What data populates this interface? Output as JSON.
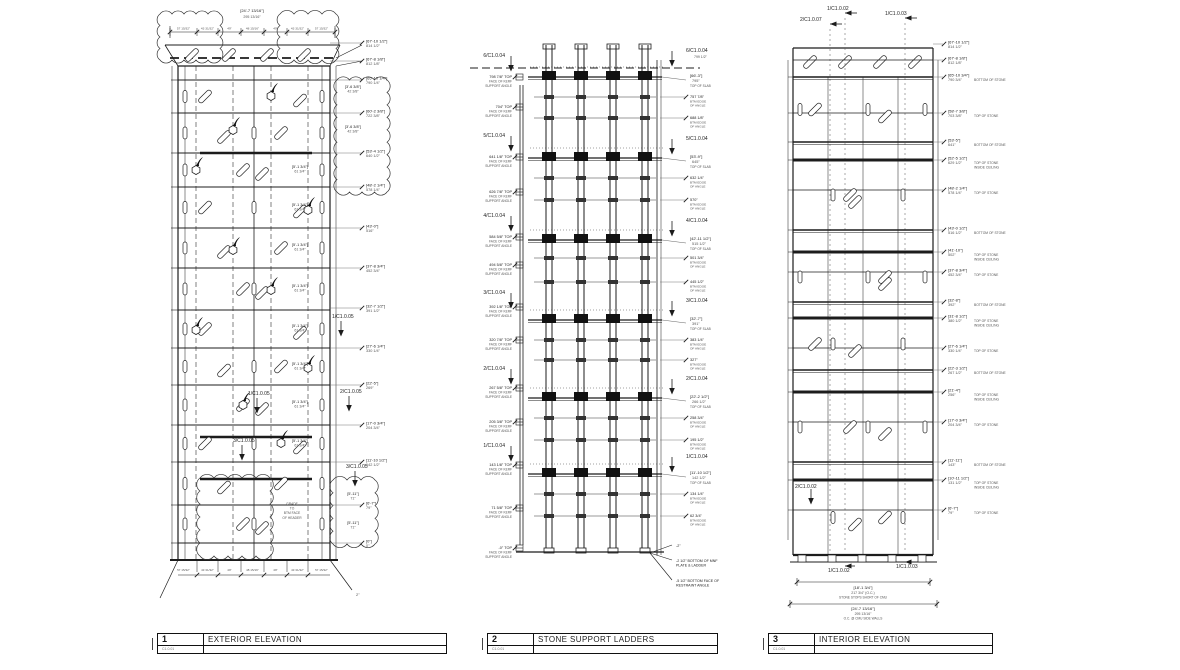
{
  "colors": {
    "ink": "#1c1c1c",
    "dim": "#555555",
    "bg": "#ffffff"
  },
  "title_blocks": [
    {
      "number": "1",
      "title": "EXTERIOR ELEVATION",
      "scale": "C1.0.01"
    },
    {
      "number": "2",
      "title": "STONE SUPPORT LADDERS",
      "scale": "C1.0.01"
    },
    {
      "number": "3",
      "title": "INTERIOR ELEVATION",
      "scale": "C1.0.01"
    }
  ],
  "exterior": {
    "top_dim": {
      "bracket": "[24'-7 13/16\"]",
      "value": "295 13/16\""
    },
    "subdims": [
      "57 15/32\"",
      "43 31/32\"",
      "49\"",
      "48 15/16\"",
      "49\"",
      "43 31/32\"",
      "57 15/32\""
    ],
    "right_labels": [
      {
        "y": 43,
        "b": "[67'-10 1/2\"]",
        "v": "814 1/2\""
      },
      {
        "y": 61,
        "b": "[67'-8 1/8\"]",
        "v": "812 1/8\""
      },
      {
        "y": 80,
        "b": "[65'-10 1/4\"]",
        "v": "790 1/4\""
      },
      {
        "y": 113,
        "b": "[60'-2 3/8\"]",
        "v": "722 3/8\""
      },
      {
        "y": 153,
        "b": "[53'-4 1/2\"]",
        "v": "640 1/2\""
      },
      {
        "y": 187,
        "b": "[48'-2 1/4\"]",
        "v": "578 1/4\""
      },
      {
        "y": 228,
        "b": "[43'-0\"]",
        "v": "516\""
      },
      {
        "y": 268,
        "b": "[37'-8 3/4\"]",
        "v": "452 3/4\""
      },
      {
        "y": 308,
        "b": "[32'-7 1/2\"]",
        "v": "391 1/2\""
      },
      {
        "y": 348,
        "b": "[27'-6 1/4\"]",
        "v": "330 1/4\""
      },
      {
        "y": 385,
        "b": "[22'-5\"]",
        "v": "269\""
      },
      {
        "y": 425,
        "b": "[17'-0 3/4\"]",
        "v": "204 3/4\""
      },
      {
        "y": 462,
        "b": "[11'-10 1/2\"]",
        "v": "142 1/2\""
      },
      {
        "y": 505,
        "b": "[6'-7\"]",
        "v": "79\""
      },
      {
        "y": 543,
        "b": "[0\"]",
        "v": "0\""
      }
    ],
    "cell_labels": [
      {
        "x": 353,
        "y": 88,
        "b": "[3'-6 3/8\"]",
        "v": "42 3/8\""
      },
      {
        "x": 353,
        "y": 128,
        "b": "[3'-6 3/8\"]",
        "v": "42 3/8\""
      },
      {
        "x": 300,
        "y": 168,
        "b": "[5'-1 3/4\"]",
        "v": "61 3/4\""
      },
      {
        "x": 300,
        "y": 206,
        "b": "[5'-1 3/4\"]",
        "v": "61 3/4\""
      },
      {
        "x": 300,
        "y": 246,
        "b": "[5'-1 3/4\"]",
        "v": "61 3/4\""
      },
      {
        "x": 300,
        "y": 287,
        "b": "[5'-1 3/4\"]",
        "v": "61 3/4\""
      },
      {
        "x": 300,
        "y": 327,
        "b": "[5'-1 3/4\"]",
        "v": "61 3/4\""
      },
      {
        "x": 300,
        "y": 365,
        "b": "[5'-1 3/4\"]",
        "v": "61 3/4\""
      },
      {
        "x": 300,
        "y": 403,
        "b": "[5'-1 3/4\"]",
        "v": "61 3/4\""
      },
      {
        "x": 300,
        "y": 442,
        "b": "[5'-1 3/4\"]",
        "v": "61 3/4\""
      },
      {
        "x": 353,
        "y": 495,
        "b": "[5'-11\"]",
        "v": "71\""
      },
      {
        "x": 353,
        "y": 524,
        "b": "[5'-11\"]",
        "v": "71\""
      }
    ],
    "callouts": [
      {
        "x": 332,
        "y": 318,
        "t": "1/C1.0.05"
      },
      {
        "x": 248,
        "y": 395,
        "t": "1/C1.0.05"
      },
      {
        "x": 340,
        "y": 393,
        "t": "2/C1.0.05"
      },
      {
        "x": 233,
        "y": 442,
        "t": "3/C1.0.05"
      },
      {
        "x": 346,
        "y": 468,
        "t": "3/C1.0.05"
      }
    ],
    "grade_note": [
      "GRADE",
      "TO",
      "BTM FACE",
      "OF HEADER"
    ],
    "bottom_note": "2\""
  },
  "ladders": {
    "left_caption": [
      "FACE OF KERF",
      "SUPPORT ANGLE"
    ],
    "left_callouts": [
      {
        "y": 55,
        "t": "6/C1.0.04"
      },
      {
        "y": 135,
        "t": "5/C1.0.04"
      },
      {
        "y": 215,
        "t": "4/C1.0.04"
      },
      {
        "y": 292,
        "t": "3/C1.0.04"
      },
      {
        "y": 368,
        "t": "2/C1.0.04"
      },
      {
        "y": 445,
        "t": "1/C1.0.04"
      }
    ],
    "left_labels": [
      {
        "y": 77,
        "v": "798 7/8\" TOP"
      },
      {
        "y": 107,
        "v": "704\" TOP"
      },
      {
        "y": 157,
        "v": "641 1/8\" TOP"
      },
      {
        "y": 192,
        "v": "626 7/8\" TOP"
      },
      {
        "y": 237,
        "v": "584 5/8\" TOP"
      },
      {
        "y": 265,
        "v": "494 5/8\" TOP"
      },
      {
        "y": 307,
        "v": "392 1/8\" TOP"
      },
      {
        "y": 340,
        "v": "320 7/8\" TOP"
      },
      {
        "y": 388,
        "v": "267 5/8\" TOP"
      },
      {
        "y": 422,
        "v": "205 3/8\" TOP"
      },
      {
        "y": 465,
        "v": "143 1/8\" TOP"
      },
      {
        "y": 508,
        "v": "71 5/8\" TOP"
      },
      {
        "y": 548,
        "v": "-0\" TOP"
      }
    ],
    "right_items": [
      {
        "t": "callout",
        "y": 50,
        "ref": "6/C1.0.04",
        "sub": "799 1/2\""
      },
      {
        "t": "slab",
        "y": 77,
        "b": "[66'-3\"]",
        "v": "795\""
      },
      {
        "t": "angle",
        "y": 97,
        "v": "757 7/8\""
      },
      {
        "t": "angle",
        "y": 118,
        "v": "688 1/8\""
      },
      {
        "t": "callout",
        "y": 138,
        "ref": "5/C1.0.04"
      },
      {
        "t": "slab",
        "y": 158,
        "b": "[53'-9\"]",
        "v": "645\""
      },
      {
        "t": "angle",
        "y": 178,
        "v": "632 1/4\""
      },
      {
        "t": "angle",
        "y": 200,
        "v": "570\""
      },
      {
        "t": "callout",
        "y": 220,
        "ref": "4/C1.0.04"
      },
      {
        "t": "slab",
        "y": 240,
        "b": "[42'-11 1/2\"]",
        "v": "515 1/2\""
      },
      {
        "t": "angle",
        "y": 258,
        "v": "501 3/4\""
      },
      {
        "t": "angle",
        "y": 282,
        "v": "445 1/2\""
      },
      {
        "t": "callout",
        "y": 300,
        "ref": "3/C1.0.04"
      },
      {
        "t": "slab",
        "y": 320,
        "b": "[32'-7\"]",
        "v": "391\""
      },
      {
        "t": "angle",
        "y": 340,
        "v": "383 1/4\""
      },
      {
        "t": "angle",
        "y": 360,
        "v": "327\""
      },
      {
        "t": "callout",
        "y": 378,
        "ref": "2/C1.0.04"
      },
      {
        "t": "slab",
        "y": 398,
        "b": "[22'-2 1/2\"]",
        "v": "266 1/2\""
      },
      {
        "t": "angle",
        "y": 418,
        "v": "258 3/4\""
      },
      {
        "t": "angle",
        "y": 440,
        "v": "195 1/2\""
      },
      {
        "t": "callout",
        "y": 456,
        "ref": "1/C1.0.04"
      },
      {
        "t": "slab",
        "y": 474,
        "b": "[11'-10 1/2\"]",
        "v": "142 1/2\""
      },
      {
        "t": "angle",
        "y": 494,
        "v": "134 1/4\""
      },
      {
        "t": "angle",
        "y": 516,
        "v": "62 3/4\""
      },
      {
        "t": "note",
        "y": 545,
        "lines": [
          "-2\""
        ]
      },
      {
        "t": "note",
        "y": 560,
        "lines": [
          "-2 1/2\" BOTTOM OF MNF",
          "PLATE & LADDER"
        ]
      },
      {
        "t": "note",
        "y": 580,
        "lines": [
          "-5 1/2\" BOTTOM FACE OF",
          "RESTRAINT ANGLE"
        ]
      }
    ]
  },
  "interior": {
    "top_callouts": [
      {
        "t": "2/C1.0.07",
        "x": 800,
        "y": 21,
        "xv": 830
      },
      {
        "t": "1/C1.0.02",
        "x": 827,
        "y": 10,
        "xv": 845
      },
      {
        "t": "1/C1.0.03",
        "x": 885,
        "y": 15,
        "xv": 905
      }
    ],
    "left_callout": {
      "t": "2/C1.0.02",
      "x": 795,
      "y": 488
    },
    "right_labels": [
      {
        "y": 44,
        "b": "[67'-10 1/2\"]",
        "v": "814 1/2\"",
        "c": []
      },
      {
        "y": 60,
        "b": "[67'-8 1/8\"]",
        "v": "812 1/8\"",
        "c": []
      },
      {
        "y": 77,
        "b": "[65'-10 3/4\"]",
        "v": "790 3/4\"",
        "c": [
          "BOTTOM OF STONE"
        ]
      },
      {
        "y": 113,
        "b": "[58'-7 3/8\"]",
        "v": "703 3/8\"",
        "c": [
          "TOP OF STONE"
        ]
      },
      {
        "y": 142,
        "b": "[53'-5\"]",
        "v": "641\"",
        "c": [
          "BOTTOM OF STONE"
        ]
      },
      {
        "y": 160,
        "b": "[52'-5 1/2\"]",
        "v": "629 1/2\"",
        "c": [
          "TOP OF STONE",
          "INSIDE CEILING"
        ]
      },
      {
        "y": 190,
        "b": "[48'-2 1/4\"]",
        "v": "578 1/4\"",
        "c": [
          "TOP OF STONE"
        ]
      },
      {
        "y": 230,
        "b": "[43'-0 1/2\"]",
        "v": "516 1/2\"",
        "c": [
          "BOTTOM OF STONE"
        ]
      },
      {
        "y": 252,
        "b": "[41'-10\"]",
        "v": "502\"",
        "c": [
          "TOP OF STONE",
          "INSIDE CEILING"
        ]
      },
      {
        "y": 272,
        "b": "[37'-8 3/4\"]",
        "v": "452 3/4\"",
        "c": [
          "TOP OF STONE"
        ]
      },
      {
        "y": 302,
        "b": "[32'-8\"]",
        "v": "392\"",
        "c": [
          "BOTTOM OF STONE"
        ]
      },
      {
        "y": 318,
        "b": "[31'-8 1/2\"]",
        "v": "380 1/2\"",
        "c": [
          "TOP OF STONE",
          "INSIDE CEILING"
        ]
      },
      {
        "y": 348,
        "b": "[27'-6 1/4\"]",
        "v": "330 1/4\"",
        "c": [
          "TOP OF STONE"
        ]
      },
      {
        "y": 370,
        "b": "[22'-3 1/2\"]",
        "v": "267 1/2\"",
        "c": [
          "BOTTOM OF STONE"
        ]
      },
      {
        "y": 392,
        "b": "[21'-4\"]",
        "v": "256\"",
        "c": [
          "TOP OF STONE",
          "INSIDE CEILING"
        ]
      },
      {
        "y": 422,
        "b": "[17'-0 3/4\"]",
        "v": "204 3/4\"",
        "c": [
          "TOP OF STONE"
        ]
      },
      {
        "y": 462,
        "b": "[11'-11\"]",
        "v": "143\"",
        "c": [
          "BOTTOM OF STONE"
        ]
      },
      {
        "y": 480,
        "b": "[10'-11 1/2\"]",
        "v": "131 1/2\"",
        "c": [
          "TOP OF STONE",
          "INSIDE CEILING"
        ]
      },
      {
        "y": 510,
        "b": "[6'-7\"]",
        "v": "79\"",
        "c": [
          "TOP OF STONE"
        ]
      }
    ],
    "bottom_callouts": [
      {
        "t": "1/C1.0.02",
        "x": 828,
        "y": 572,
        "xv": 845
      },
      {
        "t": "1/C1.0.03",
        "x": 896,
        "y": 568,
        "xv": 905
      }
    ],
    "bottom_dims": [
      {
        "b": "[18'-1 3/4\"]",
        "v": "217 3/4\"  (O.C.)",
        "c": "STONE STOPS SHORT OF CMU"
      },
      {
        "b": "[24'-7 13/16\"]",
        "v": "295 13/16\"",
        "c": "O.C. @ CMU SIDE WALLS"
      }
    ]
  }
}
